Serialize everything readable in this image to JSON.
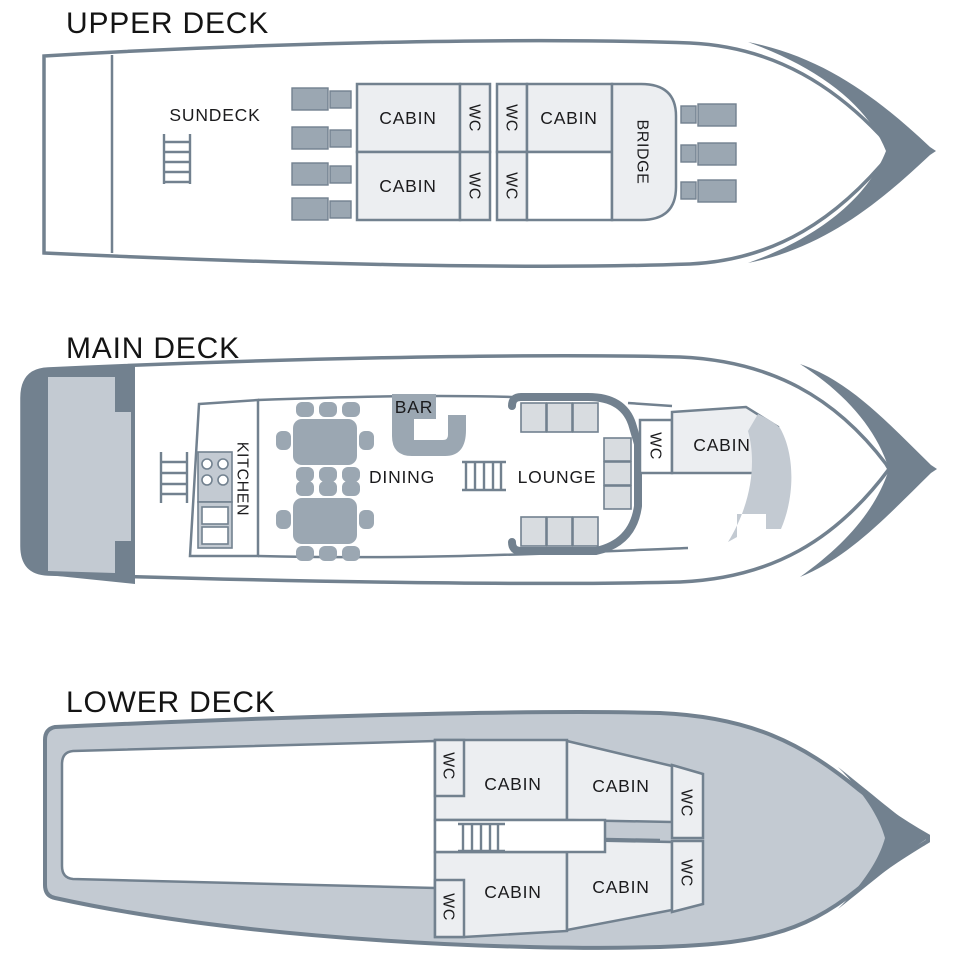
{
  "colors": {
    "slate": "#72818F",
    "slate_light": "#9BA7B2",
    "band": "#C3CAD2",
    "room": "#ECEEF1",
    "seat": "#D8DCE0",
    "text": "#1B1B1D"
  },
  "decks": {
    "upper": {
      "title": "UPPER DECK",
      "sundeck": "SUNDECK",
      "cabin_tl": "CABIN",
      "cabin_tr": "CABIN",
      "cabin_bl": "CABIN",
      "bridge": "BRIDGE",
      "wc_1": "WC",
      "wc_2": "WC",
      "wc_3": "WC",
      "wc_4": "WC"
    },
    "main": {
      "title": "MAIN DECK",
      "kitchen": "KITCHEN",
      "bar": "BAR",
      "dining": "DINING",
      "lounge": "LOUNGE",
      "wc": "WC",
      "cabin": "CABIN"
    },
    "lower": {
      "title": "LOWER DECK",
      "wc_aft_top": "WC",
      "wc_aft_bottom": "WC",
      "wc_fwd_top": "WC",
      "wc_fwd_bottom": "WC",
      "cabin_tl": "CABIN",
      "cabin_tr": "CABIN",
      "cabin_bl": "CABIN",
      "cabin_br": "CABIN"
    }
  }
}
